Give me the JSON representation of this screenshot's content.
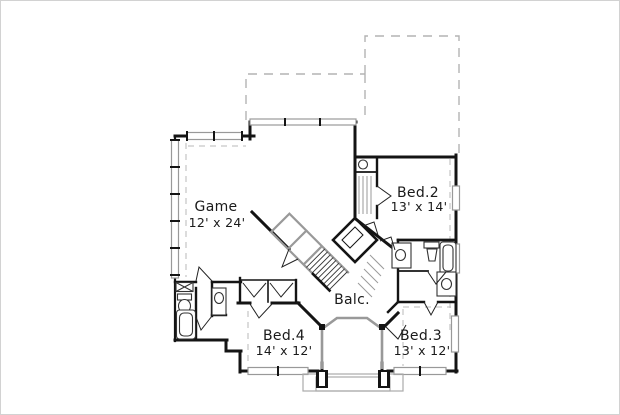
{
  "plan": {
    "kind": "second-floor-plan",
    "rooms": [
      {
        "id": "game",
        "name": "Game",
        "dimensions": "12' x 24'"
      },
      {
        "id": "bed2",
        "name": "Bed.2",
        "dimensions": "13' x 14'"
      },
      {
        "id": "balcony",
        "name": "Balc.",
        "dimensions": ""
      },
      {
        "id": "bed4",
        "name": "Bed.4",
        "dimensions": "14' x 12'"
      },
      {
        "id": "bed3",
        "name": "Bed.3",
        "dimensions": "13' x 12'"
      }
    ],
    "colors": {
      "wall": "#141414",
      "window": "#999999",
      "roof_dash": "#b3b3b3",
      "porch": "#aaaaaa",
      "text": "#1a1a1a",
      "frame": "#d2d2d2"
    }
  }
}
